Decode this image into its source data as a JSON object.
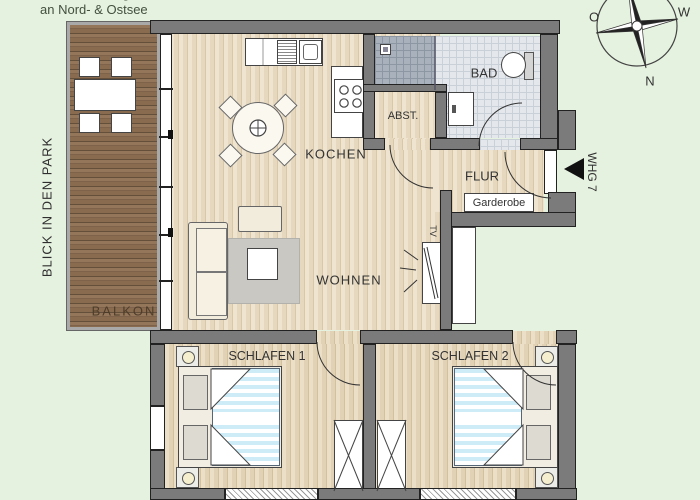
{
  "header": {
    "line1": "Ferienwohnungen",
    "line2": "an Nord- & Ostsee"
  },
  "compass": {
    "o": "O",
    "w": "W",
    "n": "N"
  },
  "rooms": {
    "balkon": "BALKON",
    "kochen": "KOCHEN",
    "wohnen": "WOHNEN",
    "abstellraum": "ABST.",
    "bad": "BAD",
    "flur": "FLUR",
    "schlafen1": "SCHLAFEN 1",
    "schlafen2": "SCHLAFEN 2"
  },
  "annotations": {
    "park_view": "BLICK IN DEN PARK",
    "garderobe": "Garderobe",
    "whg": "WHG 7",
    "tv": "TV"
  },
  "colors": {
    "background": "#e6f2e0",
    "wall": "#7b7b7b",
    "wood_floor": "#e6d8bf",
    "balcony_wood": "#8a6e54",
    "bath_tile": "#e4e8ec",
    "shower_tile": "#a9b2bc",
    "duvet_stripe": "#cdecf7",
    "rug": "#c9c8c3",
    "text": "#333333"
  }
}
